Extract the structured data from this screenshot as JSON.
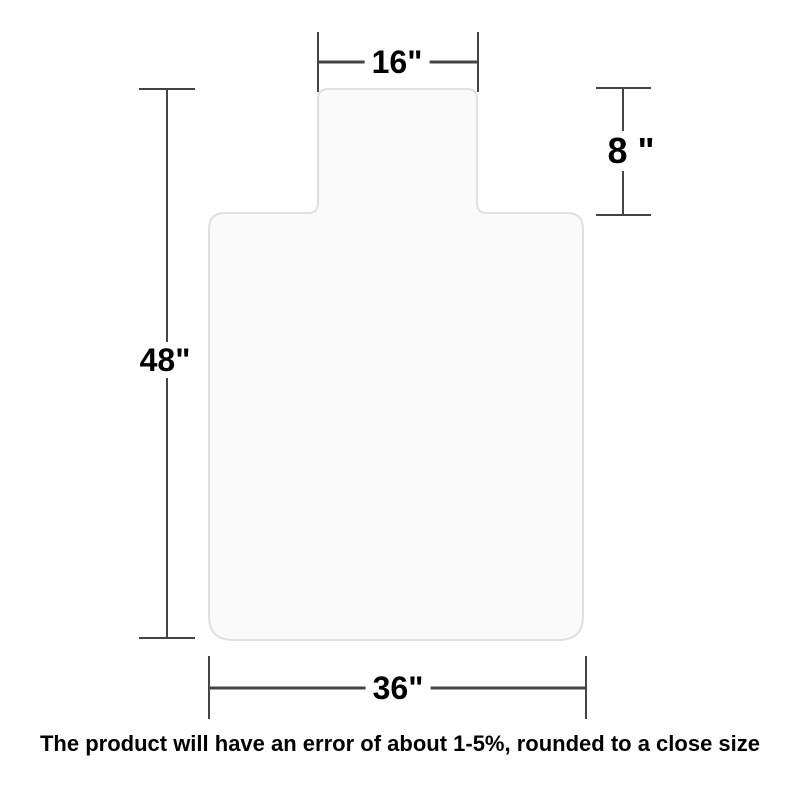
{
  "diagram": {
    "title": "chair-mat-with-lip-dimension-diagram",
    "dimensions": {
      "lip_width": "16\"",
      "lip_depth": "8 \"",
      "total_height": "48\"",
      "mat_width": "36\""
    },
    "note": "The product will have an error of about 1-5%, rounded to a close size",
    "colors": {
      "background": "#ffffff",
      "mat_fill": "#fafafa",
      "mat_border": "#e0e0e0",
      "dimension_line": "#444444",
      "label_text": "#000000"
    }
  }
}
